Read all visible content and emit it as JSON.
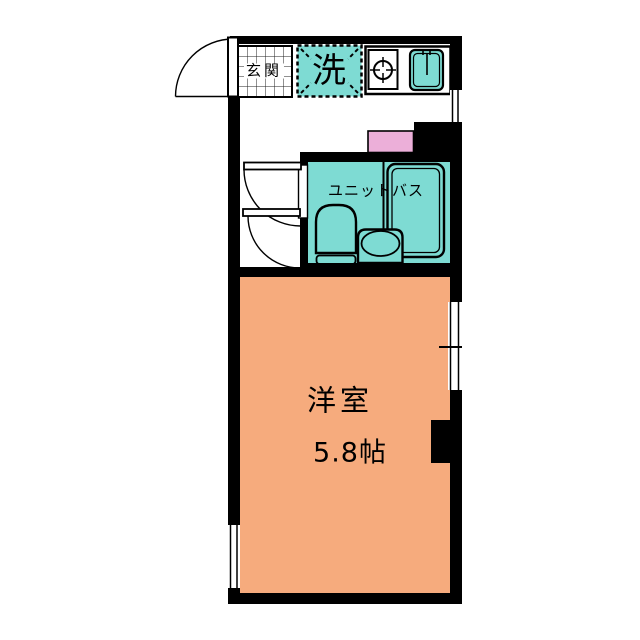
{
  "labels": {
    "genkan": "玄関",
    "laundry": "洗",
    "unit_bath": "ユニットバス",
    "room": "洋室",
    "room_size": "5.8帖"
  },
  "colors": {
    "room-fill": "#F6AB7D",
    "wet-fill": "#7EDBD3",
    "accent-pink": "#ECAFD9",
    "wall": "#000000",
    "line": "#000000",
    "bg": "#FFFFFF"
  }
}
